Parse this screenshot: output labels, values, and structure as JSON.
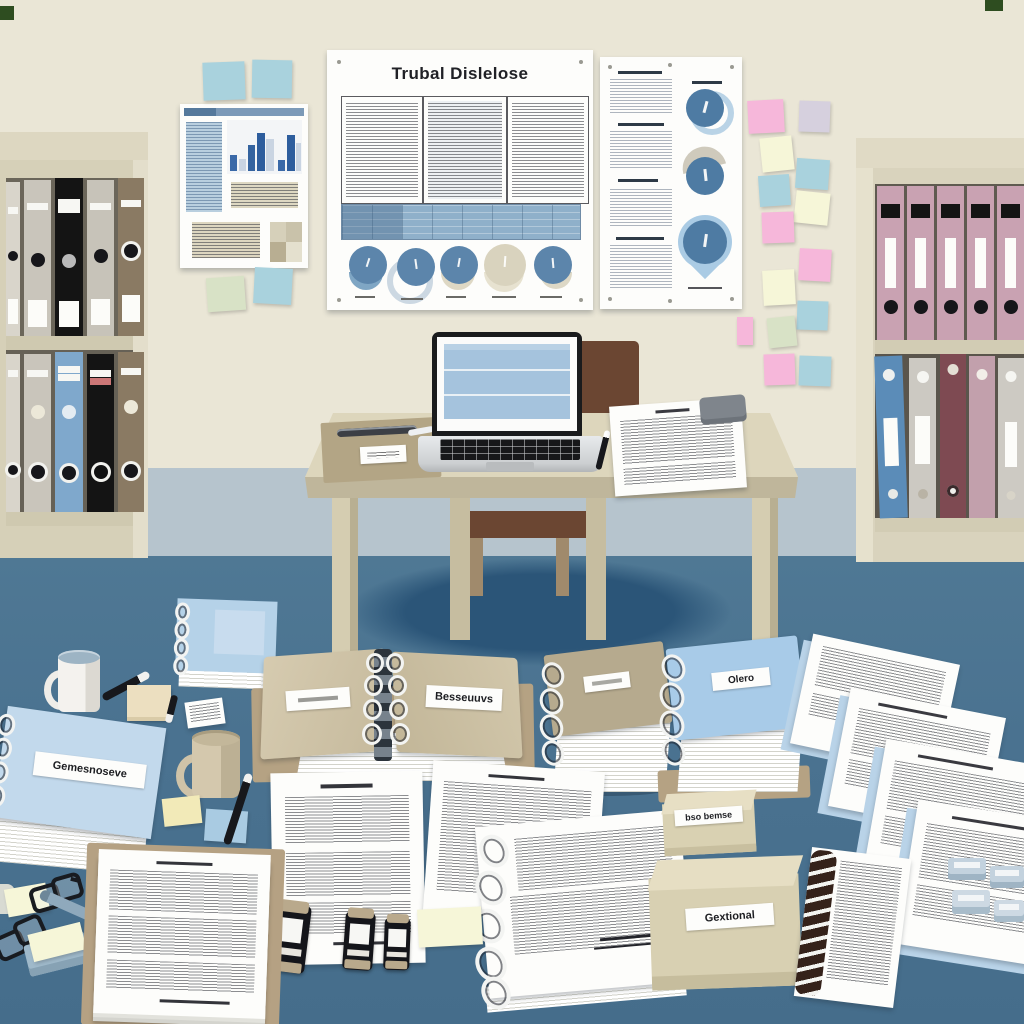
{
  "scene": {
    "type": "flat-illustration",
    "setting": "office-study-with-desk-and-documents"
  },
  "colors": {
    "wall": "#eae6d6",
    "floor_upper_band": "#b6c4cd",
    "floor": "#4b7390",
    "under_desk_shadow": "#2b5578",
    "desk_top": "#ddd6bc",
    "desk_front": "#bfb69b",
    "desk_leg": "#d2caae",
    "chair_brown": "#6b4632",
    "poster_white": "#fdfdfb",
    "accent_blue": "#5c85ab",
    "light_blue_panel": "#a5c3dd",
    "binder_tan": "#b6aa8e",
    "binder_blue": "#a8cbe8",
    "shelf_beige": "#d6d0b8",
    "sticky_pink": "#f6b7da",
    "sticky_cream": "#f6f6d8",
    "sticky_blue": "#a9d2dd",
    "sticky_lavender": "#d6d0de",
    "sticky_green": "#d8e2c6",
    "sticky_yellow": "#f2eab8"
  },
  "posters": {
    "left": {
      "name": "infographic-poster-with-bar-chart"
    },
    "center": {
      "title": "Trubal Dislelose",
      "name": "document-poster-with-pie-charts"
    },
    "right": {
      "name": "infographic-poster-with-donut-charts"
    }
  },
  "labels": {
    "open_binder": "Besseuuvs",
    "blue_binder_stack": "Olero",
    "blue_folder": "Gemesnoseve",
    "small_box": "bso bemse",
    "large_box": "Gextional"
  },
  "shelves": {
    "left": {
      "top_row": [
        "#d9d5cb",
        "#c9c5bb",
        "#141414",
        "#c7c3b9",
        "#8a7a63"
      ],
      "bottom_row": [
        "#d9d5cb",
        "#c9c5bb",
        "#7fa8cc",
        "#141414",
        "#8a7a63"
      ]
    },
    "right": {
      "top_row": [
        "#c9a2b2",
        "#c9a2b2",
        "#c9a2b2",
        "#c9a2b2",
        "#c9a2b2"
      ],
      "bottom_row": [
        "#5b8cb8",
        "#ccc9c2",
        "#7e4a52",
        "#c2a0ac",
        "#cdcac3"
      ]
    }
  },
  "wall_sticky_notes": {
    "upper_left": [
      "#a9d2dd",
      "#a9d2dd"
    ],
    "below_left_poster": [
      "#d8e2c6",
      "#a9d2dd"
    ],
    "right_column": [
      "#f6b7da",
      "#d6d0de",
      "#f6f6d8",
      "#a9d2dd",
      "#a9d2dd",
      "#f6f6d8",
      "#f6b7da",
      "#f6b7da",
      "#f6f6d8",
      "#a9d2dd",
      "#d8e2c6",
      "#f6b7da",
      "#f6b7da",
      "#a9d2dd"
    ]
  }
}
